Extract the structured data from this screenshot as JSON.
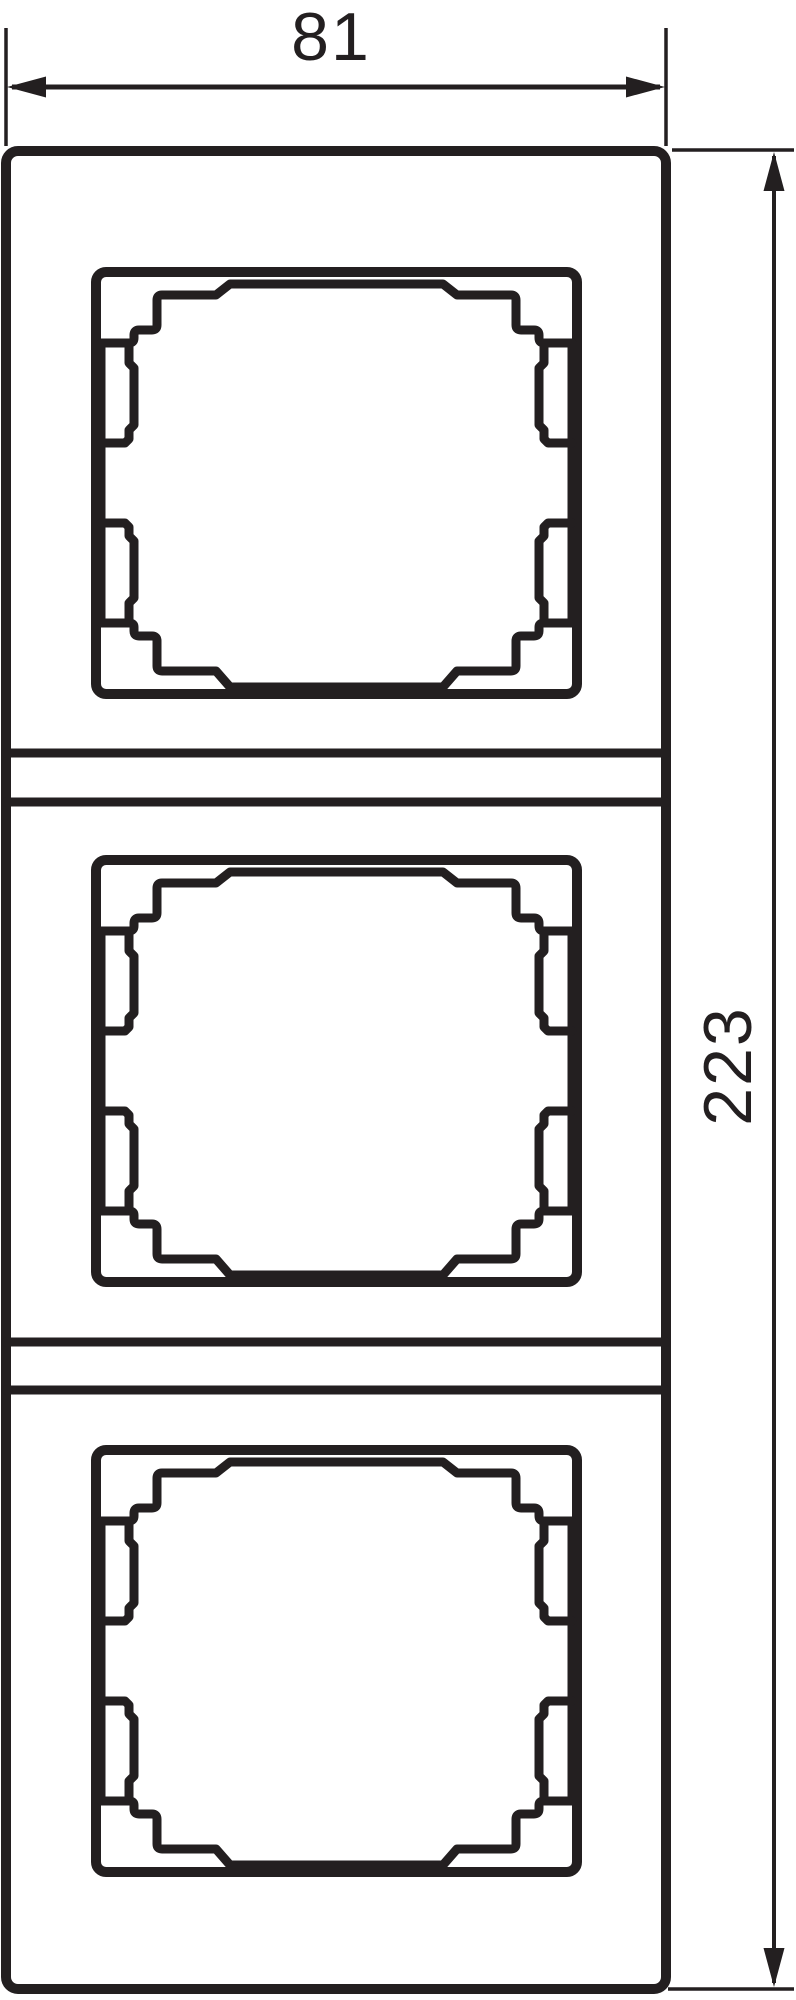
{
  "drawing": {
    "line_color": "#231f20",
    "background_color": "#ffffff",
    "width_dimension_label": "81",
    "height_dimension_label": "223"
  }
}
